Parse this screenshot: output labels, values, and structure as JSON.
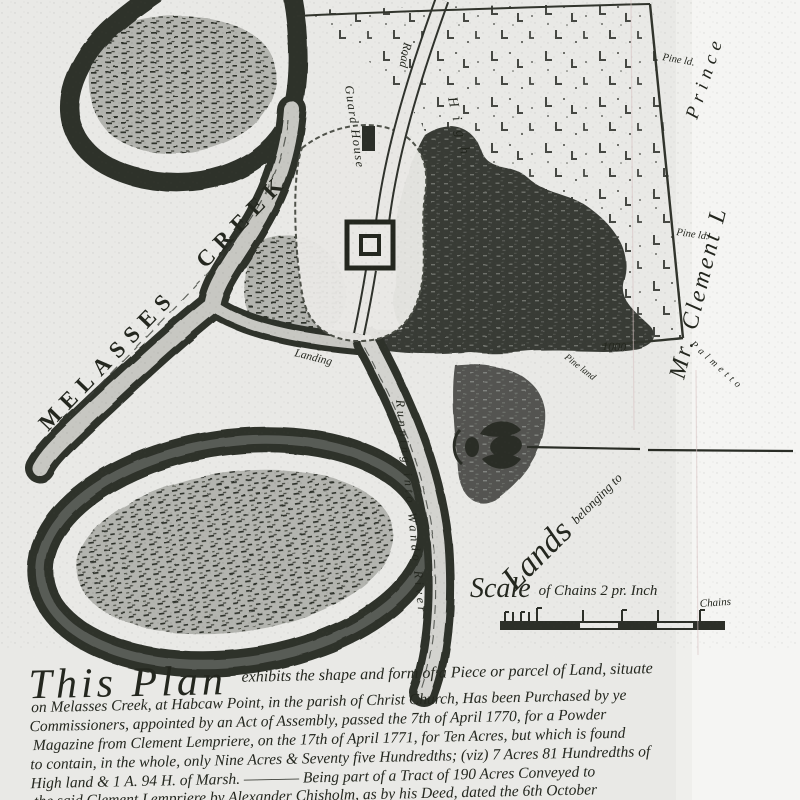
{
  "document_type": "scanned historical survey plat",
  "colors": {
    "ink": "#282b26",
    "paper": "#e9e9e6",
    "paper_light": "#f5f5f3",
    "marsh_dark": "#3a3d3a"
  },
  "map": {
    "labels": {
      "creek": "MELASSES CREEK",
      "guard": "Guard House",
      "road": "Road",
      "high": "High",
      "landing": "Landing",
      "wando": "Running into Wando River",
      "lands_big": "Lands",
      "lands_rest": "belonging to",
      "clement": "Mr. Clement L",
      "prince": "Prince",
      "pine1": "Pine ld.",
      "pine2": "Pine ld.",
      "pine3": "Pine land",
      "palmetto": "Palmetto",
      "dist": "1000"
    },
    "scale": {
      "big": "Scale",
      "rest": "of Chains 2 pr. Inch",
      "unit": "Chains"
    }
  },
  "description": {
    "opening": "This Plan",
    "line1": "exhibits the shape and form of a Piece or parcel of Land, situate",
    "lines": [
      "on Melasses Creek, at Habcaw Point, in the parish of Christ Church, Has been Purchased by ye",
      "Commissioners, appointed by an Act of Assembly, passed the 7th of April 1770, for a Powder",
      "Magazine from Clement Lempriere, on the 17th of April 1771, for Ten Acres, but which is found",
      "to contain, in the whole, only Nine Acres & Seventy five Hundredths; (viz) 7 Acres 81 Hundredths of",
      "High land & 1 A. 94 H. of Marsh. ———— Being part of a Tract of 190 Acres Conveyed to",
      "the said Clement Lempriere by Alexander Chisholm, as by his Deed, dated the 6th October"
    ]
  }
}
